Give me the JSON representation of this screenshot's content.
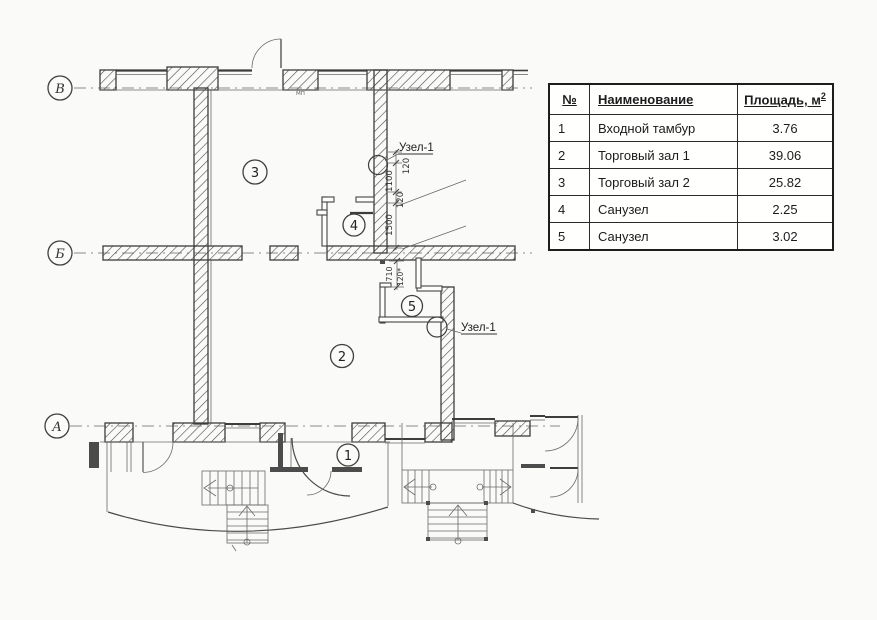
{
  "plan": {
    "axes": [
      {
        "label": "В"
      },
      {
        "label": "Б"
      },
      {
        "label": "А"
      }
    ],
    "rooms": [
      {
        "number": "1"
      },
      {
        "number": "2"
      },
      {
        "number": "3"
      },
      {
        "number": "4"
      },
      {
        "number": "5"
      }
    ],
    "details": [
      {
        "text": "Узел-1"
      },
      {
        "text": "Узел-1"
      }
    ],
    "dims": [
      "120",
      "1100",
      "120",
      "1500",
      "710",
      "120*"
    ],
    "window_label": "МП"
  },
  "table": {
    "headers": {
      "num": "№",
      "name": "Наименование",
      "area": "Площадь, м",
      "area_sup": "2"
    },
    "rows": [
      {
        "num": "1",
        "name": "Входной тамбур",
        "area": "3.76"
      },
      {
        "num": "2",
        "name": "Торговый зал 1",
        "area": "39.06"
      },
      {
        "num": "3",
        "name": "Торговый зал 2",
        "area": "25.82"
      },
      {
        "num": "4",
        "name": "Санузел",
        "area": "2.25"
      },
      {
        "num": "5",
        "name": "Санузел",
        "area": "3.02"
      }
    ]
  },
  "colors": {
    "ink": "#3d3d3d",
    "paper": "#fafaf8"
  }
}
